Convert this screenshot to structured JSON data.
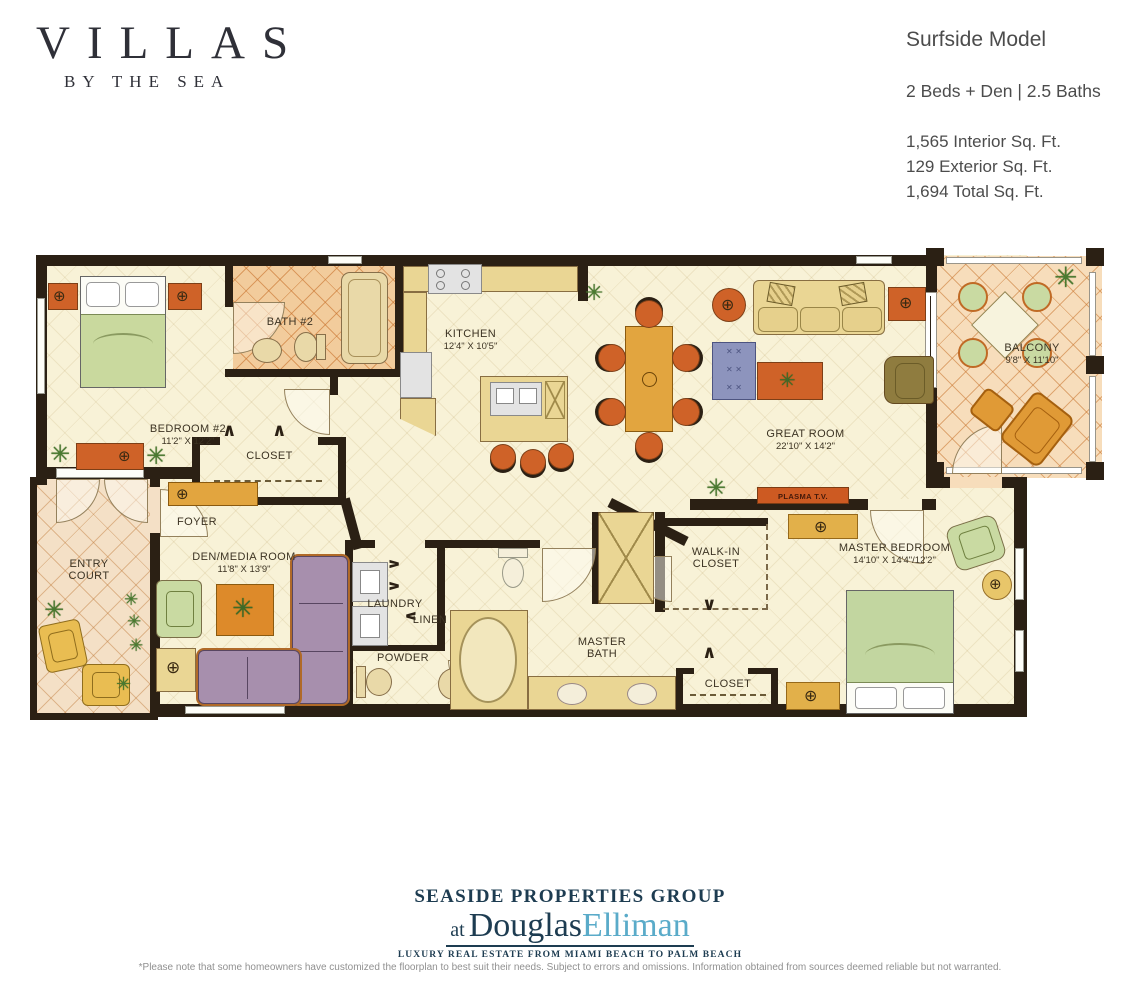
{
  "brand": {
    "name": "VILLAS",
    "sub": "BY THE SEA"
  },
  "header": {
    "model": "Surfside Model",
    "beds_baths": "2 Beds + Den | 2.5 Baths",
    "interior": "1,565 Interior Sq. Ft.",
    "exterior": "129 Exterior Sq. Ft.",
    "total": "1,694 Total Sq. Ft."
  },
  "rooms": {
    "bedroom2": {
      "name": "BEDROOM #2",
      "dims": "11'2\" X 12'2\""
    },
    "bath2": {
      "name": "BATH #2"
    },
    "closet_bed2": {
      "name": "CLOSET"
    },
    "kitchen": {
      "name": "KITCHEN",
      "dims": "12'4\" X 10'5\""
    },
    "great_room": {
      "name": "GREAT ROOM",
      "dims": "22'10\" X 14'2\""
    },
    "balcony": {
      "name": "BALCONY",
      "dims": "9'8\" X 11'10\""
    },
    "entry_court": {
      "name": "ENTRY COURT"
    },
    "foyer": {
      "name": "FOYER"
    },
    "den": {
      "name": "DEN/MEDIA ROOM",
      "dims": "11'8\" X 13'9\""
    },
    "laundry": {
      "name": "LAUNDRY"
    },
    "linen": {
      "name": "LINEN"
    },
    "powder": {
      "name": "POWDER"
    },
    "master_bath": {
      "name": "MASTER BATH"
    },
    "walkin": {
      "name": "WALK-IN CLOSET"
    },
    "closet_master": {
      "name": "CLOSET"
    },
    "master_bedroom": {
      "name": "MASTER BEDROOM",
      "dims": "14'10\" X 14'4\"/12'2\""
    },
    "plasma": {
      "name": "PLASMA T.V."
    }
  },
  "icons": {
    "plant": "✳",
    "fixture": "⊕",
    "chevron_up": "∧",
    "chevron_down": "∨"
  },
  "footer": {
    "group": "SEASIDE PROPERTIES GROUP",
    "at": "at",
    "brand1": "Douglas",
    "brand2": "Elliman",
    "tagline": "LUXURY REAL ESTATE FROM MIAMI BEACH TO PALM BEACH",
    "disclaimer": "*Please note that some homeowners have customized the floorplan to best suit their needs. Subject to errors and omissions. Information obtained from sources deemed reliable but not warranted."
  },
  "colors": {
    "wall": "#2b2014",
    "floor": "#f8f2d7",
    "tile": "#f7ddbb",
    "accent_orange": "#cf6228",
    "logo_navy": "#1d3c51",
    "logo_teal": "#5aabc9"
  }
}
